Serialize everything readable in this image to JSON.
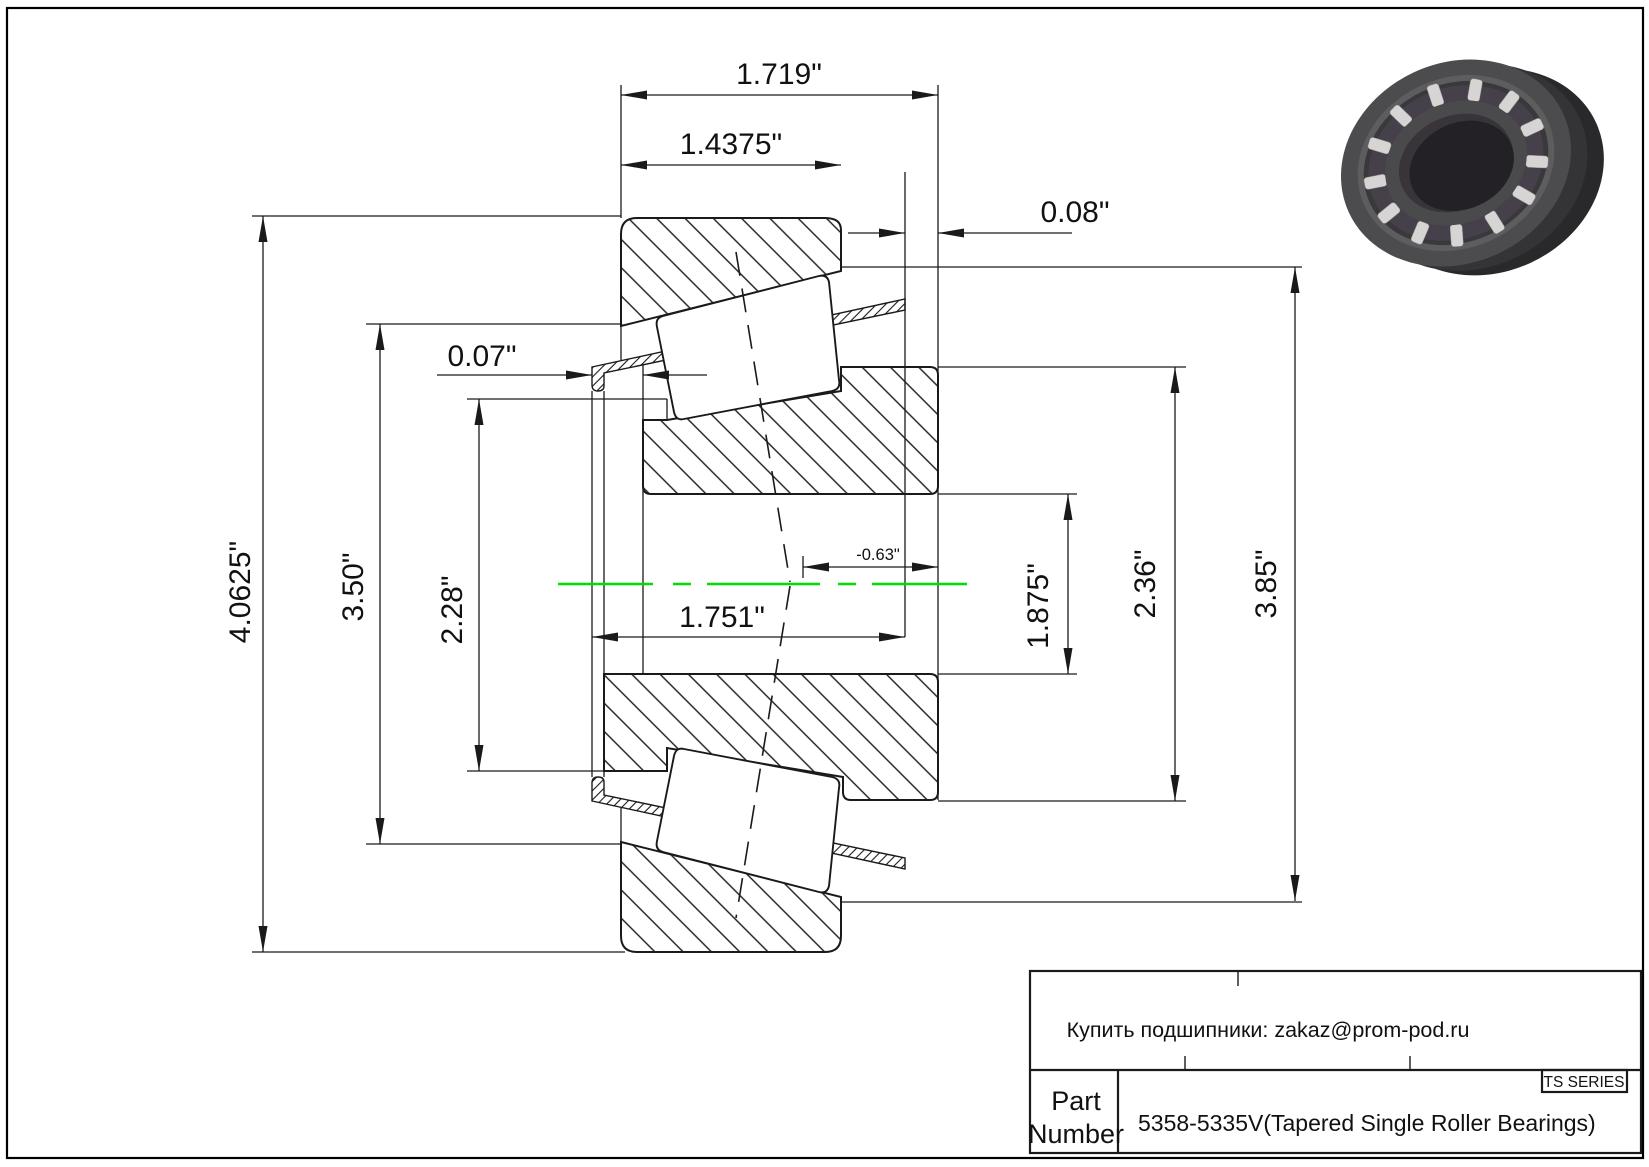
{
  "drawing": {
    "type": "tapered-roller-bearing-cross-section",
    "centerline_color": "#00dd00",
    "line_color": "#1a1a1a",
    "dims": {
      "outer_width": "1.719\"",
      "cup_width": "1.4375\"",
      "back_offset": "0.08\"",
      "front_offset": "0.07\"",
      "housing_od": "4.0625\"",
      "flange_od": "3.50\"",
      "rib_od": "2.28\"",
      "bore_width": "1.751\"",
      "effective_center": "-0.63\"",
      "inner_dia_small": "1.875\"",
      "inner_dia_mid": "2.36\"",
      "outer_dia_right": "3.85\""
    }
  },
  "title_block": {
    "vendor_note": "Купить подшипники: zakaz@prom-pod.ru",
    "series": "TS SERIES",
    "part_label_line1": "Part",
    "part_label_line2": "Number",
    "part_number": "5358-5335V(Tapered Single Roller Bearings)"
  }
}
